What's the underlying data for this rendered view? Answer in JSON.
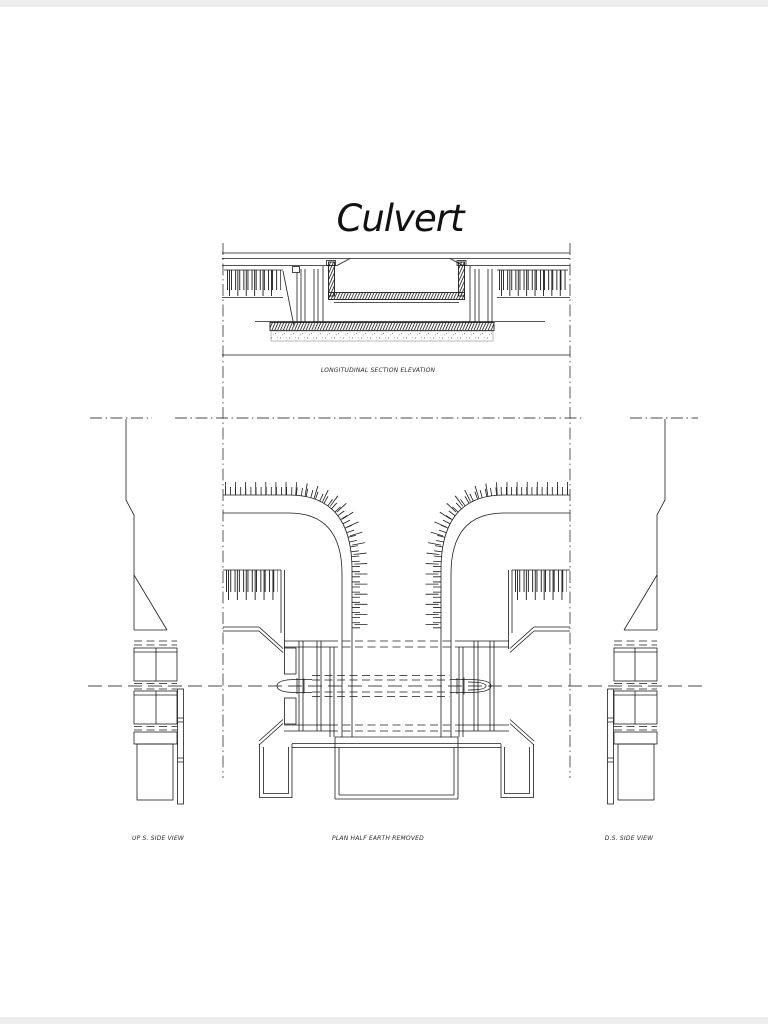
{
  "colors": {
    "line": "#1c1c1c",
    "centerline": "#4a4a4a",
    "paper": "#ffffff",
    "edge": "#ededed"
  },
  "drawing": {
    "title": "Culvert",
    "views": {
      "longitudinal_section": {
        "label": "LONGITUDINAL SECTION ELEVATION"
      },
      "plan": {
        "label": "PLAN HALF EARTH REMOVED"
      },
      "upstream_side": {
        "label": "UP S. SIDE VIEW"
      },
      "downstream_side": {
        "label": "D.S. SIDE VIEW"
      }
    }
  }
}
